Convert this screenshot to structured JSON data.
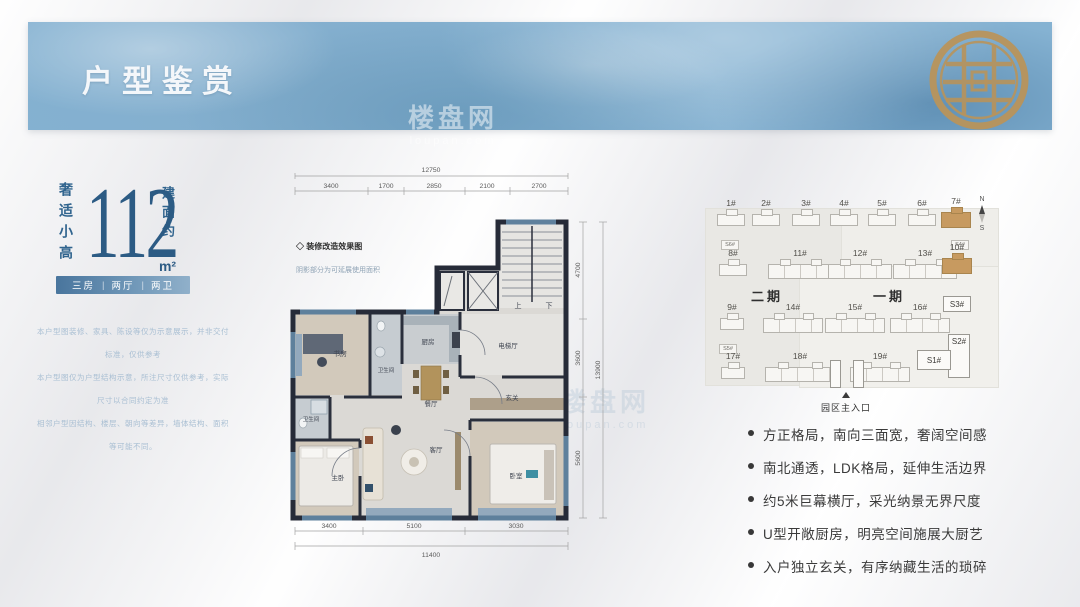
{
  "banner": {
    "title": "户型鉴赏"
  },
  "left_panel": {
    "tagline_vertical": "奢适小高",
    "area_value": "112",
    "area_prefix_vertical": "建面约",
    "area_unit": "m²",
    "tags": [
      "三房",
      "两厅",
      "两卫"
    ],
    "tag_divider": "|",
    "disclaimer_lines": [
      "本户型图装修、家具、陈设等仅为示意展示，并非交付标准，仅供参考",
      "本户型图仅为户型结构示意，所注尺寸仅供参考，实际尺寸以合同约定为准",
      "相邻户型因结构、楼层、朝向等差异，墙体结构、面积等可能不同。"
    ]
  },
  "floorplan": {
    "note_title": "◇ 装修改造效果图",
    "note_sub": "阴影部分为可延展使用面积",
    "rooms": {
      "study": "书房",
      "bath1": "卫生间",
      "kitchen": "厨房",
      "elevator_hall": "电梯厅",
      "dining": "餐厅",
      "foyer": "玄关",
      "bath2": "卫生间",
      "master_bedroom": "主卧",
      "living": "客厅",
      "bedroom": "卧室",
      "stair_up": "上",
      "stair_down": "下"
    },
    "dimensions": {
      "top_total": "12750",
      "top_segments": [
        "3400",
        "1700",
        "2850",
        "2100",
        "2700"
      ],
      "right_segments": [
        "4700",
        "3600",
        "5600"
      ],
      "right_total": "13900",
      "bottom_segments": [
        "3400",
        "5100",
        "3030"
      ],
      "bottom_total": "11400"
    }
  },
  "siteplan": {
    "phase2_label": "二期",
    "phase1_label": "一期",
    "row1": [
      "1#",
      "2#",
      "3#",
      "4#",
      "5#",
      "6#",
      "7#"
    ],
    "row2": [
      "8#",
      "11#",
      "12#",
      "13#",
      "10#"
    ],
    "row3": [
      "9#",
      "14#",
      "15#",
      "16#"
    ],
    "row4": [
      "17#",
      "18#",
      "19#"
    ],
    "s_buildings": {
      "s3": "S3#",
      "s2": "S2#",
      "s1": "S1#"
    },
    "pods": {
      "left_top": "S6#",
      "right_top": "S4#",
      "left_bottom": "S5#"
    },
    "entrance_label": "园区主入口",
    "compass": {
      "north": "N",
      "south": "S"
    }
  },
  "features": [
    "方正格局，南向三面宽，奢阔空间感",
    "南北通透，LDK格局，延伸生活边界",
    "约5米巨幕横厅，采光纳景无界尺度",
    "U型开敞厨房，明亮空间施展大厨艺",
    "入户独立玄关，有序纳藏生活的琐碎"
  ],
  "watermark": {
    "name": "楼盘网",
    "domain": "loupan.com"
  },
  "colors": {
    "banner_blue": "#85b2d2",
    "accent_blue": "#2c5b84",
    "gold": "#c79a60",
    "wall_dark": "#262b38",
    "window_blue": "#5e809c"
  }
}
